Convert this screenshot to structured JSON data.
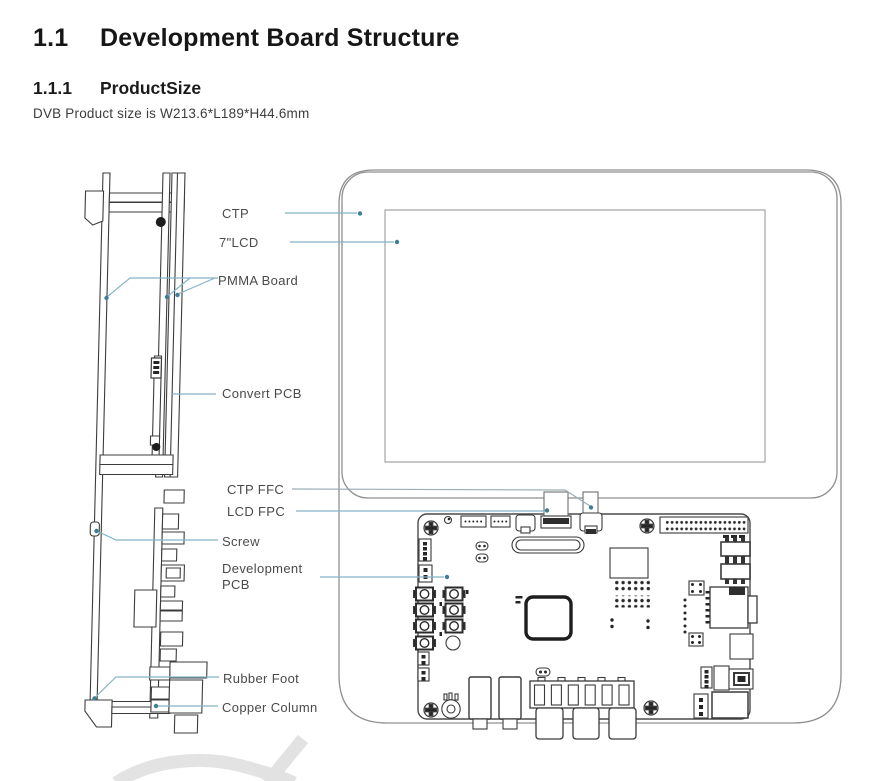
{
  "header": {
    "section_number": "1.1",
    "section_title": "Development Board Structure",
    "subsection_number": "1.1.1",
    "subsection_title": "ProductSize",
    "body_text": "DVB Product size is W213.6*L189*H44.6mm"
  },
  "diagram": {
    "labels": {
      "ctp": "CTP",
      "lcd": "7\"LCD",
      "pmma": "PMMA Board",
      "convert_pcb": "Convert PCB",
      "ctp_ffc": "CTP FFC",
      "lcd_fpc": "LCD FPC",
      "screw": "Screw",
      "development_pcb": "Development\nPCB",
      "rubber_foot": "Rubber Foot",
      "copper_column": "Copper Column"
    },
    "colors": {
      "leader_teal": "#82b5c8",
      "leader_gray": "#9badb5",
      "leader_dot": "#3e7e97",
      "panel_outline": "#8f8f8f",
      "drawing_line": "#3c3c3c",
      "watermark": "#dedede"
    }
  }
}
